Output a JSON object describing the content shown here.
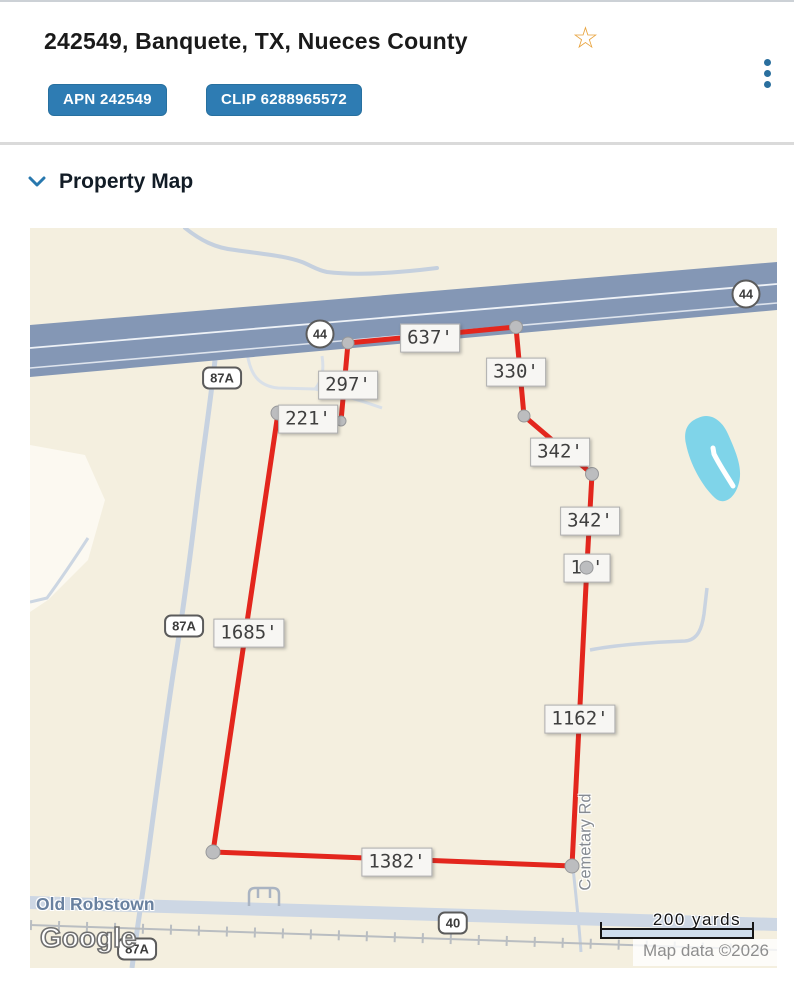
{
  "header": {
    "title": "242549, Banquete, TX, Nueces County",
    "badges": [
      "APN 242549",
      "CLIP 6288965572"
    ],
    "star_icon": "favorite-star",
    "menu_icon": "overflow-menu"
  },
  "section": {
    "title": "Property Map"
  },
  "map": {
    "measurements": [
      {
        "text": "637'"
      },
      {
        "text": "330'"
      },
      {
        "text": "297'"
      },
      {
        "text": "221'"
      },
      {
        "text": "342'"
      },
      {
        "text": "342'"
      },
      {
        "text": "1 '",
        "dot_overlay": true
      },
      {
        "text": "1685'"
      },
      {
        "text": "1162'"
      },
      {
        "text": "1382'"
      }
    ],
    "shields": [
      {
        "label": "44",
        "shape": "circle"
      },
      {
        "label": "44",
        "shape": "circle"
      },
      {
        "label": "87A",
        "shape": "rect"
      },
      {
        "label": "87A",
        "shape": "rect"
      },
      {
        "label": "40",
        "shape": "rect"
      },
      {
        "label": "87A",
        "shape": "rect"
      }
    ],
    "road_labels": {
      "old_robstown": "Old Robstown",
      "cemetery": "Cemetary Rd"
    },
    "watermark": "Google",
    "scale": {
      "label": "200 yards"
    },
    "attribution": "Map data ©2026",
    "colors": {
      "boundary": "#e3261d",
      "highway": "#8497b5",
      "water": "#7fd4e9",
      "road": "#c7d2e0",
      "background": "#f4efdf",
      "badge_blue": "#2e7cb3",
      "accent_blue": "#2878ae",
      "star_orange": "#e8a33d"
    }
  }
}
